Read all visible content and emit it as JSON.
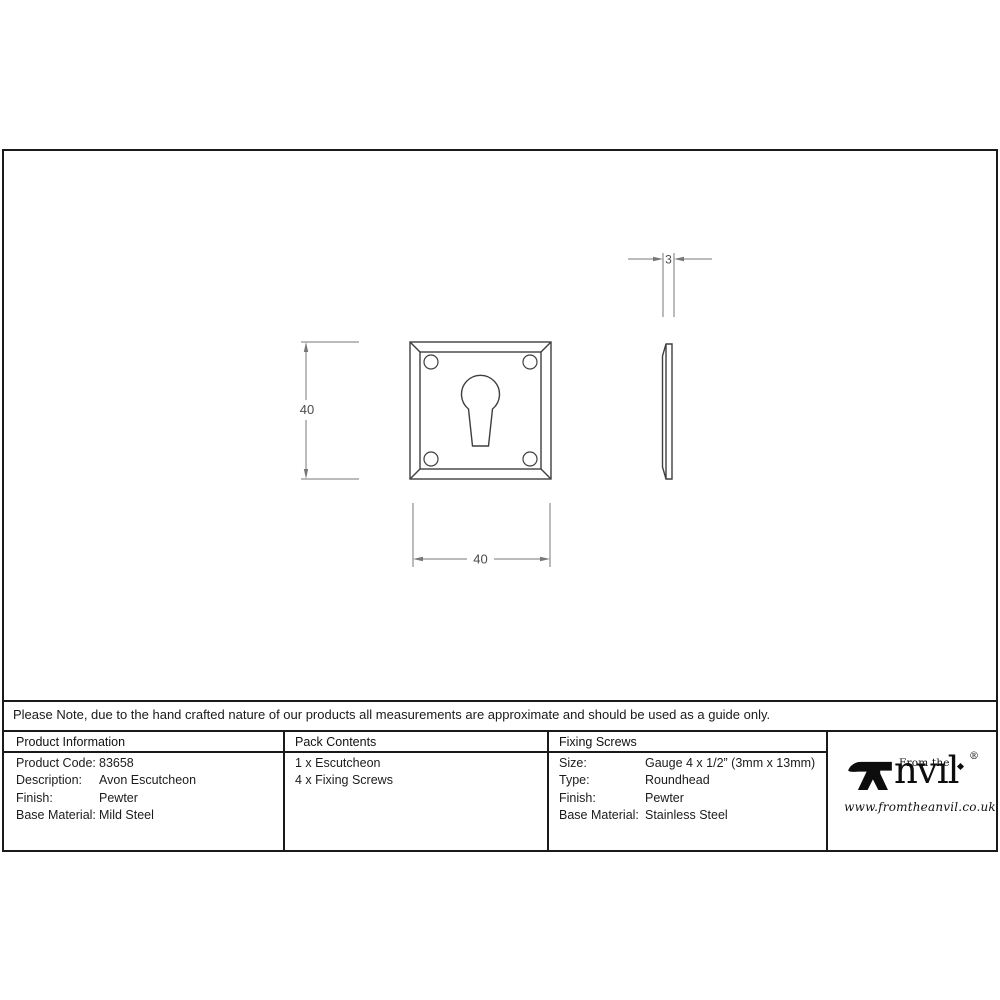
{
  "note": {
    "text": "Please Note, due to the hand crafted nature of our products all measurements are approximate and should be used as a guide only."
  },
  "drawing": {
    "dimensions": {
      "height_label": "40",
      "width_label": "40",
      "thickness_label": "3"
    },
    "views": {
      "front": "escutcheon front view with keyhole and four fixing screw holes",
      "side": "escutcheon side profile showing bevel"
    }
  },
  "table": {
    "columns": [
      {
        "header": "Product Information",
        "rows": [
          {
            "label": "Product Code:",
            "value": "83658"
          },
          {
            "label": "Description:",
            "value": "Avon Escutcheon"
          },
          {
            "label": "Finish:",
            "value": "Pewter"
          },
          {
            "label": "Base Material:",
            "value": "Mild Steel"
          }
        ]
      },
      {
        "header": "Pack Contents",
        "rows": [
          {
            "value": "1 x Escutcheon"
          },
          {
            "value": "4 x Fixing Screws"
          }
        ]
      },
      {
        "header": "Fixing Screws",
        "rows": [
          {
            "label": "Size:",
            "value": "Gauge 4 x 1/2” (3mm x 13mm)"
          },
          {
            "label": "Type:",
            "value": "Roundhead"
          },
          {
            "label": "Finish:",
            "value": "Pewter"
          },
          {
            "label": "Base Material:",
            "value": "Stainless Steel"
          }
        ]
      }
    ]
  },
  "brand": {
    "prefix": "From the",
    "wordmark": "Anvil",
    "wordmark_rest": "nvıl",
    "registered": "®",
    "url": "www.fromtheanvil.co.uk",
    "icons": {
      "initial": "anvil-icon",
      "i_dot": "diamond"
    }
  },
  "colors": {
    "frame": "#1a1a1a",
    "part_line": "#3f3f3f",
    "dimension_line": "#777777",
    "text": "#1f1f1f",
    "background": "#ffffff"
  }
}
